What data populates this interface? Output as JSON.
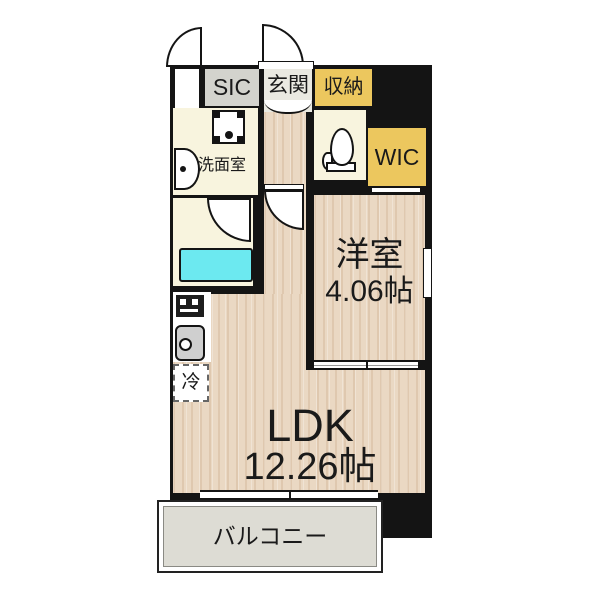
{
  "plan": {
    "type": "japanese-apartment-floor-plan",
    "labels": {
      "mb": "MB",
      "sic": "SIC",
      "genkan": "玄関",
      "storage": "収納",
      "washroom": "洗面室",
      "wic": "WIC",
      "western_room_name": "洋室",
      "western_room_size": "4.06帖",
      "ldk_name": "LDK",
      "ldk_size": "12.26帖",
      "balcony": "バルコニー",
      "refrigerator": "冷"
    },
    "icons": {
      "entrance_door": "quarter-arc-swing-door",
      "mb_door": "quarter-arc-swing-door",
      "bathroom_door": "quarter-arc-swing-door",
      "ldk_door": "quarter-arc-swing-door",
      "wic_door": "sliding-door",
      "western_room_door": "sliding-door",
      "fixtures": [
        "washing-machine",
        "wash-basin",
        "toilet",
        "bathtub",
        "stove",
        "kitchen-sink"
      ]
    },
    "colors": {
      "wall": "#141414",
      "wood_floor": "#ead8c3",
      "service_room_cream": "#f8f4de",
      "closet_yellow": "#ecc75e",
      "sic_gray": "#d3d3cd",
      "genkan_tile": "#eae9e1",
      "bathtub_cyan": "#6ce9f0",
      "balcony_gray": "#dddcd4"
    }
  }
}
